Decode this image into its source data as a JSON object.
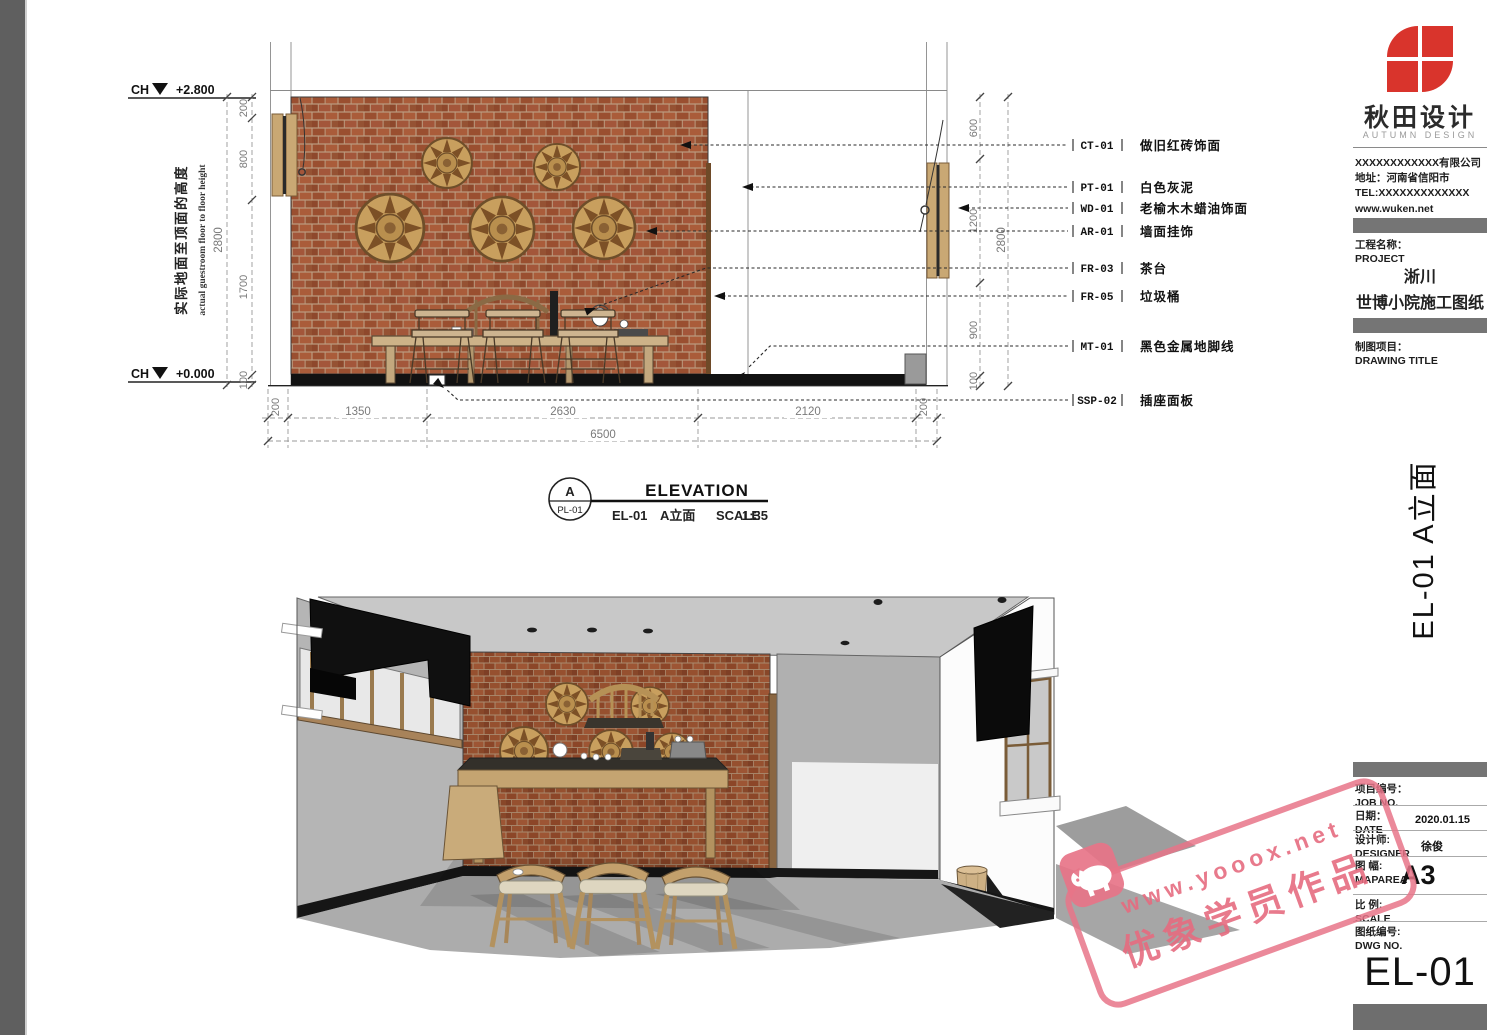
{
  "colors": {
    "left_bar": "#5f5f5f",
    "logo_red": "#d9342c",
    "watermark_pink": "#e77c8d",
    "brick": "#9a5030",
    "bar_gray": "#757575"
  },
  "elevation": {
    "level_prefix": "CH",
    "level_top": "+2.800",
    "level_bottom": "+0.000",
    "note_cn": "实际地面至顶面的高度",
    "note_en": "actual guestroom floor to floor height",
    "dims": {
      "left": [
        "200",
        "800",
        "1700",
        "100"
      ],
      "left_total": "2800",
      "right": [
        "600",
        "1200",
        "900",
        "100"
      ],
      "right_total": "2800",
      "bottom": [
        "200",
        "1350",
        "2630",
        "2120",
        "200"
      ],
      "bottom_total": "6500"
    },
    "callouts": [
      {
        "code": "CT-01",
        "label": "做旧红砖饰面"
      },
      {
        "code": "PT-01",
        "label": "白色灰泥"
      },
      {
        "code": "WD-01",
        "label": "老榆木木蜡油饰面"
      },
      {
        "code": "AR-01",
        "label": "墙面挂饰"
      },
      {
        "code": "FR-03",
        "label": "茶台"
      },
      {
        "code": "FR-05",
        "label": "垃圾桶"
      },
      {
        "code": "MT-01",
        "label": "黑色金属地脚线"
      },
      {
        "code": "SSP-02",
        "label": "插座面板"
      }
    ],
    "title": {
      "bubble": "A",
      "bubble_sub": "PL-01",
      "name": "ELEVATION",
      "code": "EL-01",
      "cn": "A立面",
      "scale_label": "SCALE",
      "scale": "1:35"
    }
  },
  "titleblock": {
    "brand": "秋田设计",
    "brand_en": "AUTUMN DESIGN",
    "company": "XXXXXXXXXXXX有限公司",
    "address": "地址：河南省信阳市",
    "tel": "TEL:XXXXXXXXXXXXX",
    "web": "www.wuken.net",
    "project_label": "工程名称：",
    "project_label_en": "PROJECT",
    "project_line1": "淅川",
    "project_line2": "世博小院施工图纸",
    "drawing_label": "制图项目：",
    "drawing_label_en": "DRAWING TITLE",
    "sheet_title": "EL-01  A立面",
    "rows": [
      {
        "label": "项目编号：",
        "en": "JOB NO.",
        "value": ""
      },
      {
        "label": "日期：",
        "en": "DATE",
        "value": "2020.01.15"
      },
      {
        "label": "设计师:",
        "en": "DESIGNER",
        "value": "徐俊"
      },
      {
        "label": "图 幅:",
        "en": "MAPAREA",
        "value": "A3"
      },
      {
        "label": "比 例:",
        "en": "SCALE",
        "value": ""
      },
      {
        "label": "图纸编号:",
        "en": "DWG NO.",
        "value": ""
      }
    ],
    "dwg_no": "EL-01"
  },
  "watermark": {
    "line1": "www.yooox.net",
    "line2": "优象学员作品"
  }
}
